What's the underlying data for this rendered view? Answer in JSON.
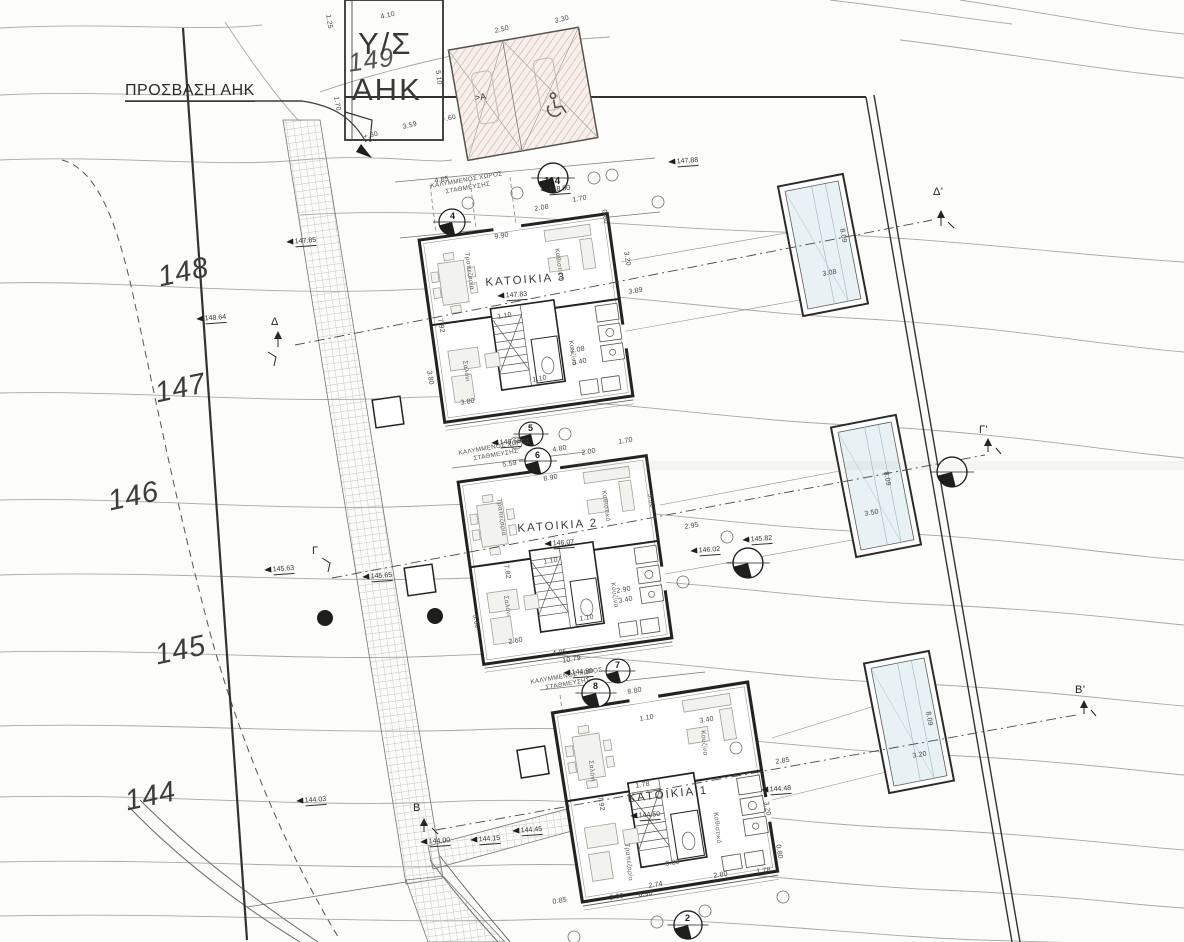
{
  "colors": {
    "paper": "#fcfcfb",
    "ink": "#23231f",
    "contour": "#a8a8a2",
    "pool": "#e8f1f4",
    "pink_hatch": "#d4a79c"
  },
  "top": {
    "substation_line1": "Υ/Σ",
    "substation_line2": "ΑΗΚ",
    "access_label": "ΠΡΟΣΒΑΣΗ ΑΗΚ",
    "section_a": ">A"
  },
  "contours": {
    "c149": "149",
    "c148": "148",
    "c147": "147",
    "c146": "146",
    "c145": "145",
    "c144": "144"
  },
  "houses": [
    {
      "name": "ΚΑΤΟΙΚΙΑ 3"
    },
    {
      "name": "ΚΑΤΟΙΚΙΑ 2"
    },
    {
      "name": "ΚΑΤΟΙΚΙΑ 1"
    }
  ],
  "rooms": {
    "living": "Καθιστικό",
    "kitchen": "Κουζίνα",
    "dining": "Τραπεζαρία",
    "lounge": "Σαλόνι"
  },
  "parking_label": {
    "line1": "ΚΑΛΥΜΜΕΝΟΣ ΧΩΡΟΣ",
    "line2": "ΣΤΑΘΜΕΥΣΗΣ"
  },
  "sections": {
    "d": "Δ",
    "d2": "Δ'",
    "g": "Γ",
    "g2": "Γ'",
    "b": "Β",
    "b2": "Β'"
  },
  "stations": {
    "s114": "114",
    "s2": "2",
    "s4": "4",
    "s5": "5",
    "s6": "6",
    "s7": "7",
    "s8": "8"
  },
  "spots": [
    "148.64",
    "148.00",
    "147.88",
    "147.85",
    "147.83",
    "146.58",
    "146.07",
    "146.02",
    "145.82",
    "145.63",
    "145.65",
    "144.89",
    "144.50",
    "144.48",
    "144.03",
    "144.00",
    "144.15",
    "144.45"
  ],
  "dims": [
    "4.10",
    "2.50",
    "3.30",
    "5.10",
    "1.25",
    "1.70",
    "3.59",
    "+.60",
    "+.60",
    "4.85",
    "2.08",
    "1.70",
    "0.80",
    "9.90",
    "3.20",
    "3.89",
    "7.92",
    "1.10",
    "2.08",
    "3.40",
    "1.10",
    "3.80",
    "3.80",
    "4.80",
    "2.00",
    "1.70",
    "5.59",
    "8.90",
    "3.30",
    "2.95",
    "7.82",
    "1.10",
    "2.90",
    "3.40",
    "1.10",
    "2.60",
    "3.60",
    "4.85",
    "10.79",
    "8.80",
    "1.10",
    "3.40",
    "7.92",
    "1.78",
    "2.85",
    "3.20",
    "0.80",
    "1.78",
    "2.80",
    "9.80",
    "2.74",
    "0.90",
    "2.00",
    "0.85",
    "3.08",
    "8.09",
    "3.50",
    "8.09",
    "3.20",
    "8.09"
  ]
}
